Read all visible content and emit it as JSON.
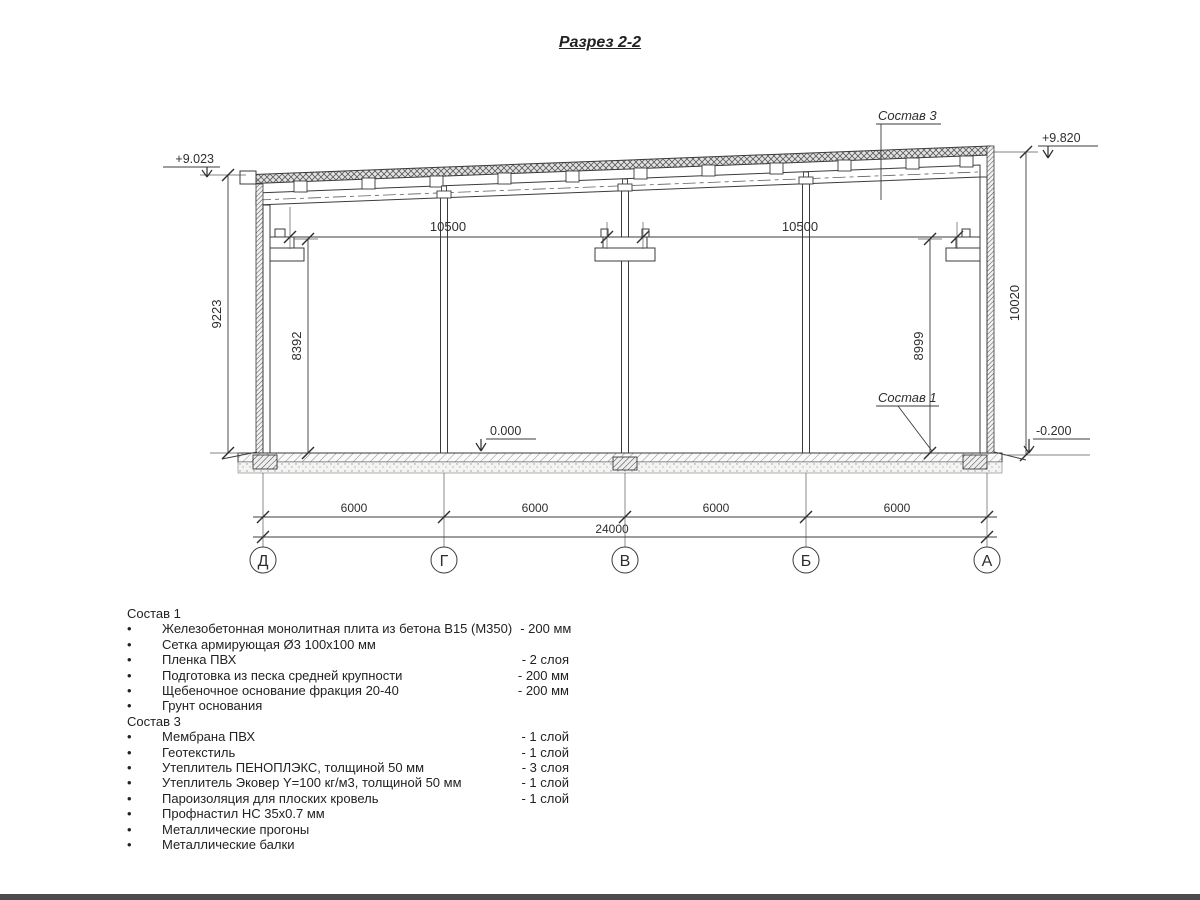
{
  "title": "Разрез 2-2",
  "drawing": {
    "elevations": {
      "top_left": "+9.023",
      "top_right": "+9.820",
      "floor": "0.000",
      "ground_right": "-0.200"
    },
    "callouts": {
      "roof": "Состав 3",
      "floor": "Состав 1"
    },
    "dimensions": {
      "span_left": "10500",
      "span_right": "10500",
      "height_left_outer": "9223",
      "height_left_inner": "8392",
      "height_right_inner": "8999",
      "height_right_outer": "10020",
      "bays": [
        "6000",
        "6000",
        "6000",
        "6000"
      ],
      "total": "24000"
    },
    "axes": [
      "Д",
      "Г",
      "В",
      "Б",
      "А"
    ]
  },
  "lists": {
    "s1": {
      "heading": "Состав 1",
      "items": [
        {
          "name": "Железобетонная монолитная плита из бетона В15 (М350)",
          "qty": "-  200 мм"
        },
        {
          "name": "Сетка армирующая Ø3 100х100 мм",
          "qty": ""
        },
        {
          "name": "Пленка ПВХ",
          "qty": "-  2 слоя"
        },
        {
          "name": "Подготовка из песка средней крупности",
          "qty": "- 200 мм"
        },
        {
          "name": "Щебеночное основание фракция 20-40",
          "qty": "- 200 мм"
        },
        {
          "name": "Грунт основания",
          "qty": ""
        }
      ]
    },
    "s3": {
      "heading": "Состав 3",
      "items": [
        {
          "name": "Мембрана ПВХ",
          "qty": "- 1 слой"
        },
        {
          "name": "Геотекстиль",
          "qty": "- 1 слой"
        },
        {
          "name": "Утеплитель ПЕНОПЛЭКС, толщиной 50 мм",
          "qty": "- 3 слоя"
        },
        {
          "name": "Утеплитель Эковер Y=100 кг/м3, толщиной 50 мм",
          "qty": "- 1 слой"
        },
        {
          "name": "Пароизоляция для плоских кровель",
          "qty": "- 1 слой"
        },
        {
          "name": "Профнастил НС 35х0.7 мм",
          "qty": ""
        },
        {
          "name": "Металлические прогоны",
          "qty": ""
        },
        {
          "name": "Металлические балки",
          "qty": ""
        }
      ]
    }
  }
}
